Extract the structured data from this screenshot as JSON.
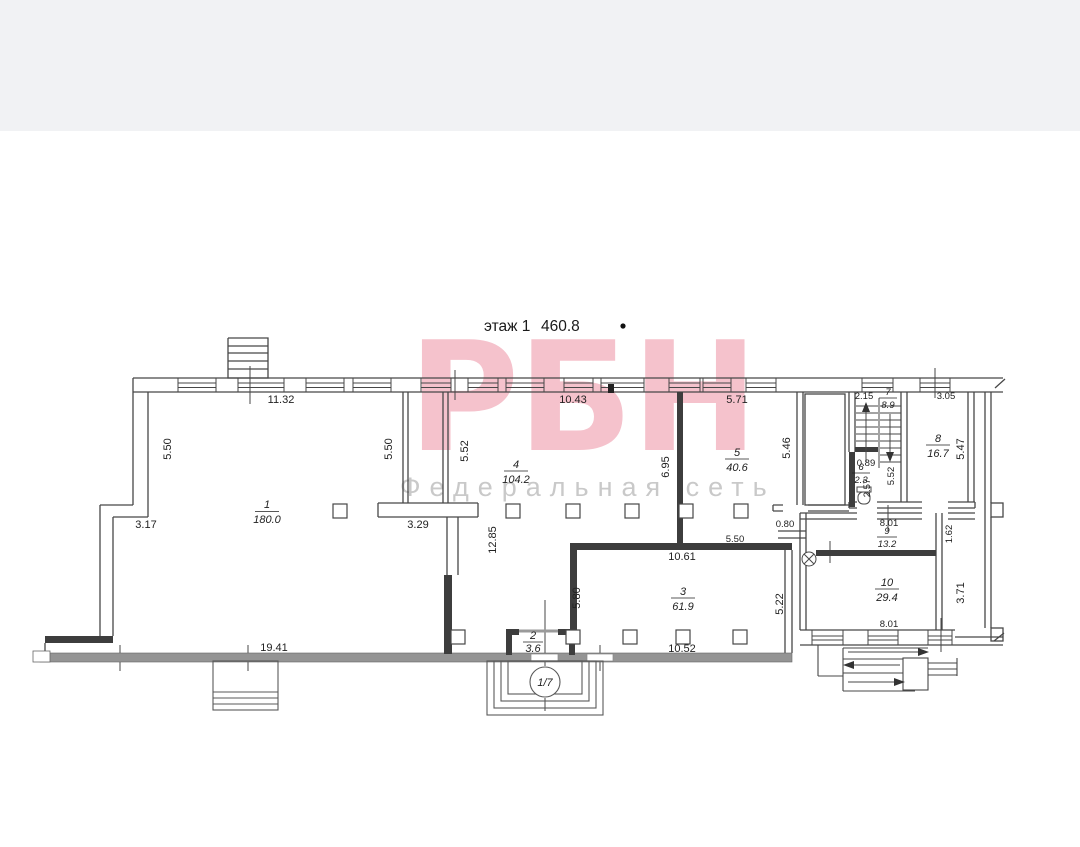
{
  "header": {
    "floor_label": "этаж 1",
    "total_area": "460.8"
  },
  "watermark": {
    "logo": "РБН",
    "subtitle": "Федеральная сеть",
    "logo_color": "#f5c2cc",
    "subtitle_color": "#c9c9c9"
  },
  "rooms": [
    {
      "num": "1",
      "area": "180.0"
    },
    {
      "num": "2",
      "area": "3.6"
    },
    {
      "num": "3",
      "area": "61.9"
    },
    {
      "num": "4",
      "area": "104.2"
    },
    {
      "num": "5",
      "area": "40.6"
    },
    {
      "num": "6",
      "area": "2.3"
    },
    {
      "num": "7",
      "area": "8.9"
    },
    {
      "num": "8",
      "area": "16.7"
    },
    {
      "num": "9",
      "area": "13.2"
    },
    {
      "num": "10",
      "area": "29.4"
    }
  ],
  "dims": {
    "top_room1": "11.32",
    "top_room4": "10.43",
    "top_room5": "5.71",
    "top_stair": "2.15",
    "top_room8": "3.05",
    "left_room1": "5.50",
    "right_room1": "5.50",
    "left_room4": "5.52",
    "right_room4": "6.95",
    "right_room5": "5.46",
    "right_room8": "5.47",
    "bottom_room1": "3.17",
    "bottom_corridor": "3.29",
    "mid_height": "12.85",
    "stair_landing": "0.89",
    "wc_height": "2.57",
    "stair_height": "5.52",
    "pass_width": "0.80",
    "room9_width": "8.01",
    "gap_width": "1.62",
    "room3_top": "5.50",
    "room3_width": "10.61",
    "room3_left": "5.80",
    "room3_right": "5.22",
    "room10_right": "3.71",
    "room10_width": "8.01",
    "bottom_left": "19.41",
    "room3_bottom": "10.52"
  },
  "entrance": {
    "marker": "1/7"
  }
}
